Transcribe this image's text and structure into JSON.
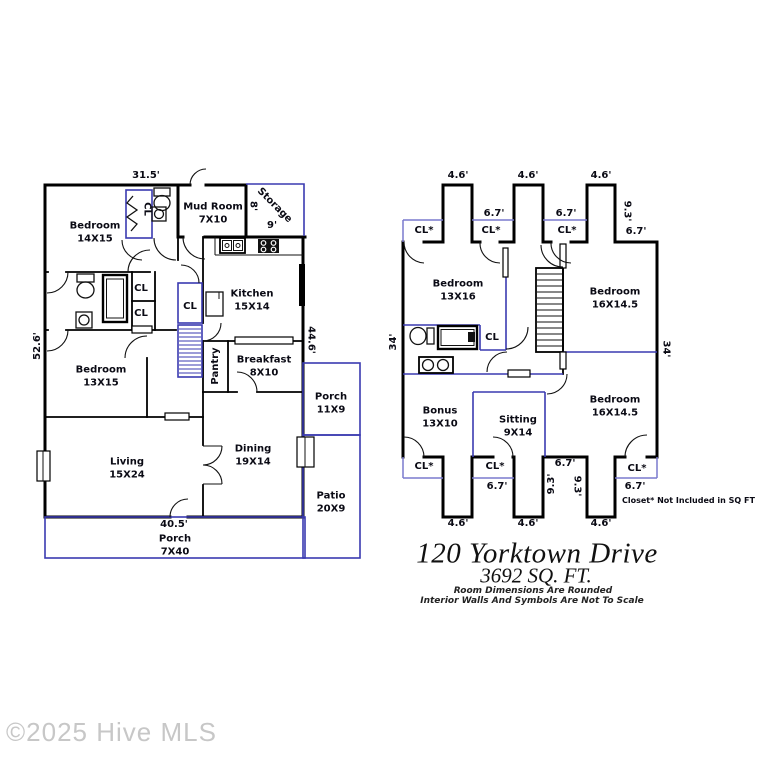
{
  "watermark": {
    "text": "©2025 Hive MLS"
  },
  "title_block": {
    "address": "120 Yorktown Drive",
    "square_footage": "3692 SQ. FT.",
    "note_1": "Room Dimensions Are Rounded",
    "note_2": "Interior Walls And Symbols Are Not To Scale"
  },
  "colors": {
    "exterior_wall": "#000000",
    "interior_blue": "#3a3ab0",
    "knee_wall_blue": "#7a7ace",
    "watermark_gray": "#c7c7c7"
  },
  "first_floor": {
    "labels": {
      "width_top": "31.5'",
      "bedroom_front": "Bedroom\n14X15",
      "closet_front": "CL",
      "mud_room": "Mud Room\n7X10",
      "storage_depth": "8'",
      "storage": "Storage",
      "storage_width": "9'",
      "kitchen": "Kitchen\n15X14",
      "closet_hall_1": "CL",
      "closet_hall_2": "CL",
      "closet_center": "CL",
      "height_left": "52.6'",
      "pantry": "Pantry",
      "breakfast": "Breakfast\n8X10",
      "height_right": "44.6'",
      "bedroom_back": "Bedroom\n13X15",
      "porch_side": "Porch\n11X9",
      "living": "Living\n15X24",
      "dining": "Dining\n19X14",
      "patio": "Patio\n20X9",
      "width_bottom": "40.5'",
      "porch_front": "Porch\n7X40"
    }
  },
  "second_floor": {
    "labels": {
      "dormer_top_1": "4.6'",
      "dormer_top_2": "4.6'",
      "dormer_top_3": "4.6'",
      "closet_top_1_dim": "6.7'",
      "closet_top_2_dim": "6.7'",
      "dormer_depth_top": "9.3'",
      "closet_top_3_dim": "6.7'",
      "closet_top_1": "CL*",
      "closet_top_2": "CL*",
      "closet_top_3": "CL*",
      "bedroom_front": "Bedroom\n13X16",
      "bedroom_right_upper": "Bedroom\n16X14.5",
      "height_left": "34'",
      "height_right": "34'",
      "closet_bath": "CL",
      "bonus": "Bonus\n13X10",
      "sitting": "Sitting\n9X14",
      "bedroom_right_lower": "Bedroom\n16X14.5",
      "closet_bottom_1": "CL*",
      "closet_bottom_2": "CL*",
      "closet_bottom_3": "CL*",
      "closet_bottom_mid_dim": "6.7'",
      "dormer_depth_bottom_1": "9.3'",
      "dormer_depth_bottom_2": "9.3'",
      "closet_bottom_2_dim": "6.7'",
      "closet_bottom_3_dim": "6.7'",
      "closet_note": "Closet* Not Included in SQ FT",
      "dormer_bottom_1": "4.6'",
      "dormer_bottom_2": "4.6'",
      "dormer_bottom_3": "4.6'"
    }
  }
}
